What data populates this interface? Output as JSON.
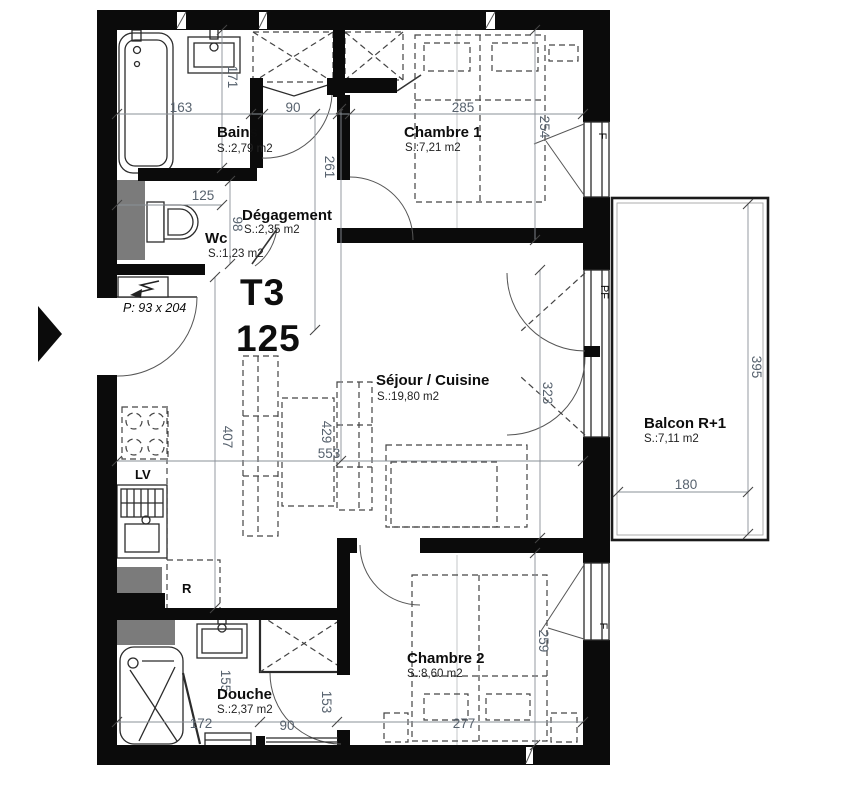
{
  "floorplan": {
    "unit": {
      "type": "T3",
      "number": "125"
    },
    "entry": {
      "door_label": "P: 93 x 204"
    },
    "rooms": {
      "bains": {
        "name": "Bains",
        "area": "S.:2,79 m2"
      },
      "degagement": {
        "name": "Dégagement",
        "area": "S.:2,35 m2"
      },
      "wc": {
        "name": "Wc",
        "area": "S.:1,23 m2"
      },
      "chambre1": {
        "name": "Chambre 1",
        "area": "S.:7,21 m2"
      },
      "sejour_cuisine": {
        "name": "Séjour / Cuisine",
        "area": "S.:19,80 m2"
      },
      "chambre2": {
        "name": "Chambre 2",
        "area": "S.:8,60 m2"
      },
      "douche": {
        "name": "Douche",
        "area": "S.:2,37 m2"
      },
      "balcon": {
        "name": "Balcon R+1",
        "area": "S.:7,11 m2"
      }
    },
    "labels": {
      "dishwasher": "LV",
      "fridge": "R",
      "window": "F",
      "french_window": "PF"
    },
    "dimensions_cm": {
      "bains_width": "163",
      "bains_depth": "171",
      "closet_width": "90",
      "chambre1_width": "285",
      "chambre1_depth": "254",
      "degagement_depth": "261",
      "wc_width": "125",
      "wc_depth": "98",
      "kitchen_run": "407",
      "sejour_depth": "429",
      "sejour_width": "553",
      "french_window_span": "323",
      "balcon_depth": "395",
      "balcon_width": "180",
      "douche_width": "172",
      "douche_door": "90",
      "douche_partition": "153",
      "douche_side": "155",
      "chambre2_width": "277",
      "chambre2_depth": "259"
    },
    "colors": {
      "wall": "#0b0b0b",
      "dimension_text": "#57626e",
      "shaft": "#7b7b7b"
    }
  }
}
